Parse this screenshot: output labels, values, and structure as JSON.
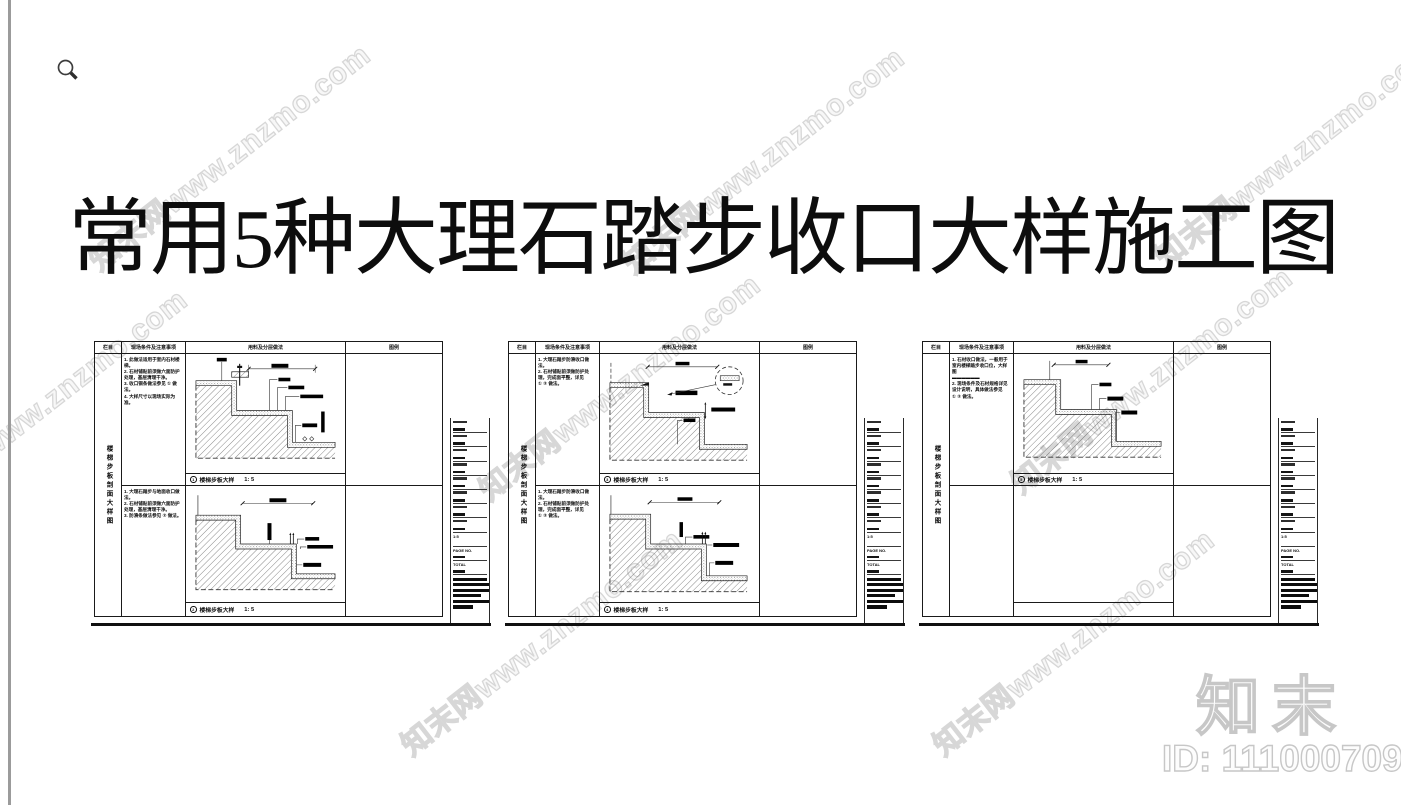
{
  "title": "常用5种大理石踏步收口大样施工图",
  "watermark": {
    "text": "知末网www.znzmo.com",
    "brand": "知末",
    "id_text": "ID: 1110007096",
    "outline_color": "#d7d7d7"
  },
  "icons": {
    "zoom": "magnifier-icon"
  },
  "titleblock": {
    "blank_rows": 8,
    "scale_value": "1:5",
    "page_no_label": "PAGE NO.",
    "total_label": "TOTAL",
    "black_bars": [
      34,
      37,
      37,
      28,
      37,
      20
    ]
  },
  "sheets": [
    {
      "header": {
        "col1": "栏目",
        "col2": "现场条件及注意事项",
        "col3": "用料及分层做法",
        "col4": "图例"
      },
      "side_label": "楼梯步板剖面大样图",
      "rows": [
        {
          "notes": "1. 此做法适用于室内石材楼梯。\n2. 石材铺贴前须做六面防护处理，基层清理干净。\n3. 收口铜条做法参见 ① 做法。\n4. 大样尺寸以现场实际为准。",
          "caption_no": "1",
          "caption": "楼梯步板大样",
          "scale": "1: 5"
        },
        {
          "notes": "1. 大理石踏步与地面收口做法。\n2. 石材铺贴前须做六面防护处理，基层清理干净。\n3. 防滑条做法参见 ② 做法。",
          "caption_no": "2",
          "caption": "楼梯步板大样",
          "scale": "1: 5"
        }
      ]
    },
    {
      "header": {
        "col1": "栏目",
        "col2": "现场条件及注意事项",
        "col3": "用料及分层做法",
        "col4": "图例"
      },
      "side_label": "楼梯步板剖面大样图",
      "rows": [
        {
          "notes": "1. 大理石踏步防滑收口做法。\n2. 石材铺贴前须做防护处理，完成面平整，详见\n① ② 做法。",
          "caption_no": "3",
          "caption": "楼梯步板大样",
          "scale": "1: 5"
        },
        {
          "notes": "1. 大理石踏步防滑收口做法。\n2. 石材铺贴前须做防护处理，完成面平整，详见\n① ② 做法。",
          "caption_no": "4",
          "caption": "楼梯步板大样",
          "scale": "1: 5"
        }
      ]
    },
    {
      "header": {
        "col1": "栏目",
        "col2": "现场条件及注意事项",
        "col3": "用料及分层做法",
        "col4": "图例"
      },
      "side_label": "楼梯步板剖面大样图",
      "rows": [
        {
          "notes": "1. 石材收口做法，一般用于室内楼梯踏步收口位，大样图\n▬▬▬▬▬▬\n2. 现场条件及石材规格详见设计说明，具体做法参见\n① ② 做法。",
          "caption_no": "5",
          "caption": "楼梯步板大样",
          "scale": "1: 5"
        },
        {
          "notes": "",
          "caption_no": "",
          "caption": "",
          "scale": ""
        }
      ]
    }
  ]
}
